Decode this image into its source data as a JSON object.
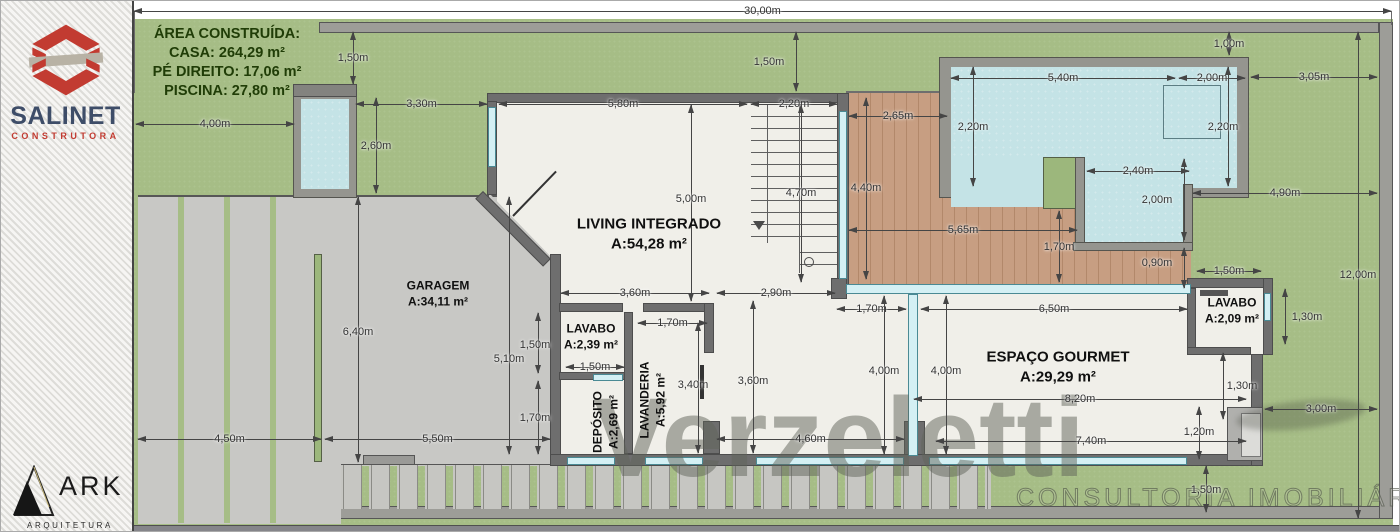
{
  "branding": {
    "salinet": {
      "name": "SALINET",
      "tagline": "CONSTRUTORA"
    },
    "ark": {
      "name": "ARK",
      "tagline": "ARQUITETURA"
    },
    "watermark": {
      "name": "Verzeletti",
      "tagline": "CONSULTORIA IMOBILIÁRIA"
    }
  },
  "info_box": {
    "title": "ÁREA CONSTRUÍDA:",
    "casa": "CASA: 264,29 m²",
    "pe_direito": "PÉ DIREITO: 17,06 m²",
    "piscina": "PISCINA: 27,80 m²"
  },
  "plan": {
    "rooms": [
      {
        "name": "GARAGEM",
        "area": "A:34,11 m²",
        "x": 437,
        "y": 293,
        "big": false
      },
      {
        "name": "LIVING INTEGRADO",
        "area": "A:54,28 m²",
        "x": 648,
        "y": 233,
        "big": true
      },
      {
        "name": "LAVABO",
        "area": "A:2,39 m²",
        "x": 590,
        "y": 336,
        "big": false
      },
      {
        "name": "DEPÓSITO",
        "area": "A:2,69 m²",
        "x": 605,
        "y": 421,
        "rot": true,
        "big": false
      },
      {
        "name": "LAVANDERIA",
        "area": "A:5,92 m²",
        "x": 652,
        "y": 399,
        "rot": true,
        "big": false
      },
      {
        "name": "ESPAÇO GOURMET",
        "area": "A:29,29 m²",
        "x": 1057,
        "y": 366,
        "big": true
      },
      {
        "name": "LAVABO",
        "area": "A:2,09 m²",
        "x": 1231,
        "y": 310,
        "big": false
      }
    ],
    "dimensions": [
      {
        "t": "30,00m",
        "o": "h",
        "a": 133,
        "b": 1390,
        "p": 10
      },
      {
        "t": "4,00m",
        "o": "h",
        "a": 135,
        "b": 293,
        "p": 123
      },
      {
        "t": "3,30m",
        "o": "h",
        "a": 355,
        "b": 486,
        "p": 103
      },
      {
        "t": "5,80m",
        "o": "h",
        "a": 498,
        "b": 746,
        "p": 103
      },
      {
        "t": "2,20m",
        "o": "h",
        "a": 750,
        "b": 836,
        "p": 103
      },
      {
        "t": "2,65m",
        "o": "h",
        "a": 848,
        "b": 946,
        "p": 115
      },
      {
        "t": "5,40m",
        "o": "h",
        "a": 950,
        "b": 1174,
        "p": 77
      },
      {
        "t": "2,00m",
        "o": "h",
        "a": 1178,
        "b": 1244,
        "p": 77
      },
      {
        "t": "3,05m",
        "o": "h",
        "a": 1250,
        "b": 1376,
        "p": 76
      },
      {
        "t": "2,40m",
        "o": "h",
        "a": 1086,
        "b": 1188,
        "p": 170
      },
      {
        "t": "4,90m",
        "o": "h",
        "a": 1192,
        "b": 1376,
        "p": 192
      },
      {
        "t": "1,50m",
        "o": "h",
        "a": 1196,
        "b": 1260,
        "p": 270
      },
      {
        "t": "5,65m",
        "o": "h",
        "a": 848,
        "b": 1076,
        "p": 229
      },
      {
        "t": "3,60m",
        "o": "h",
        "a": 560,
        "b": 708,
        "p": 292
      },
      {
        "t": "2,90m",
        "o": "h",
        "a": 716,
        "b": 834,
        "p": 292
      },
      {
        "t": "1,70m",
        "o": "h",
        "a": 836,
        "b": 905,
        "p": 308
      },
      {
        "t": "6,50m",
        "o": "h",
        "a": 920,
        "b": 1186,
        "p": 308
      },
      {
        "t": "1,70m",
        "o": "h",
        "a": 637,
        "b": 706,
        "p": 322
      },
      {
        "t": "1,50m",
        "o": "h",
        "a": 565,
        "b": 623,
        "p": 366
      },
      {
        "t": "8,20m",
        "o": "h",
        "a": 913,
        "b": 1245,
        "p": 398
      },
      {
        "t": "7,40m",
        "o": "h",
        "a": 935,
        "b": 1245,
        "p": 440
      },
      {
        "t": "4,60m",
        "o": "h",
        "a": 716,
        "b": 903,
        "p": 438
      },
      {
        "t": "4,50m",
        "o": "h",
        "a": 137,
        "b": 320,
        "p": 438
      },
      {
        "t": "5,50m",
        "o": "h",
        "a": 324,
        "b": 549,
        "p": 438
      },
      {
        "t": "3,00m",
        "o": "h",
        "a": 1264,
        "b": 1376,
        "p": 408
      },
      {
        "t": "1,50m",
        "o": "v",
        "a": 31,
        "b": 83,
        "p": 352
      },
      {
        "t": "1,50m",
        "o": "v",
        "a": 31,
        "b": 90,
        "p": 795,
        "lx": 768
      },
      {
        "t": "1,00m",
        "o": "v",
        "a": 31,
        "b": 54,
        "p": 1228
      },
      {
        "t": "2,20m",
        "o": "v",
        "a": 66,
        "b": 185,
        "p": 972
      },
      {
        "t": "2,20m",
        "o": "v",
        "a": 66,
        "b": 185,
        "p": 1227,
        "lx": 1222
      },
      {
        "t": "2,60m",
        "o": "v",
        "a": 97,
        "b": 192,
        "p": 375
      },
      {
        "t": "5,00m",
        "o": "v",
        "a": 104,
        "b": 300,
        "p": 690,
        "ly": 198
      },
      {
        "t": "4,70m",
        "o": "v",
        "a": 104,
        "b": 281,
        "p": 800,
        "ly": 192
      },
      {
        "t": "4,40m",
        "o": "v",
        "a": 97,
        "b": 278,
        "p": 865,
        "ly": 187
      },
      {
        "t": "1,70m",
        "o": "v",
        "a": 210,
        "b": 281,
        "p": 1058
      },
      {
        "t": "2,00m",
        "o": "v",
        "a": 158,
        "b": 239,
        "p": 1183,
        "lx": 1156
      },
      {
        "t": "0,90m",
        "o": "v",
        "a": 247,
        "b": 287,
        "p": 1183,
        "lx": 1156,
        "ly": 262
      },
      {
        "t": "12,00m",
        "o": "v",
        "a": 31,
        "b": 517,
        "p": 1357,
        "ly": 274
      },
      {
        "t": "1,30m",
        "o": "v",
        "a": 288,
        "b": 343,
        "p": 1284,
        "lx": 1306
      },
      {
        "t": "1,30m",
        "o": "v",
        "a": 352,
        "b": 418,
        "p": 1222,
        "lx": 1241
      },
      {
        "t": "4,00m",
        "o": "v",
        "a": 295,
        "b": 453,
        "p": 883,
        "ly": 370
      },
      {
        "t": "4,00m",
        "o": "v",
        "a": 295,
        "b": 453,
        "p": 945,
        "ly": 370
      },
      {
        "t": "3,40m",
        "o": "v",
        "a": 322,
        "b": 452,
        "p": 697,
        "lx": 692,
        "ly": 384
      },
      {
        "t": "3,60m",
        "o": "v",
        "a": 300,
        "b": 452,
        "p": 752,
        "ly": 380
      },
      {
        "t": "1,50m",
        "o": "v",
        "a": 312,
        "b": 372,
        "p": 537,
        "lx": 534,
        "ly": 344
      },
      {
        "t": "5,10m",
        "o": "v",
        "a": 196,
        "b": 453,
        "p": 508,
        "ly": 358
      },
      {
        "t": "1,70m",
        "o": "v",
        "a": 380,
        "b": 453,
        "p": 537,
        "lx": 534,
        "ly": 417
      },
      {
        "t": "6,40m",
        "o": "v",
        "a": 196,
        "b": 461,
        "p": 357,
        "ly": 331
      },
      {
        "t": "1,20m",
        "o": "v",
        "a": 406,
        "b": 458,
        "p": 1198,
        "ly": 431
      },
      {
        "t": "1,50m",
        "o": "v",
        "a": 465,
        "b": 511,
        "p": 1205,
        "ly": 489
      }
    ]
  }
}
